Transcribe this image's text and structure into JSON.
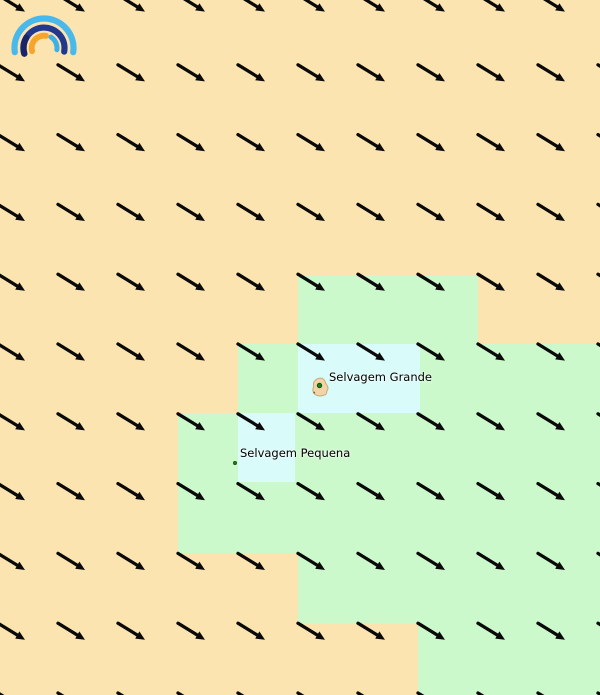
{
  "app": {
    "name": "meteoblue weather map",
    "view": "wind direction overlay"
  },
  "logo": {
    "icon": "meteoblue-rainbow-logo",
    "colors": {
      "outer_blue": "#49b8ea",
      "navy": "#22388e",
      "navy_dark": "#1a2569",
      "inner_blue": "#3fb0e5",
      "orange": "#f7a42c"
    }
  },
  "map": {
    "background_color": "#fce4b0",
    "tile_colors": {
      "peach": "#fce4b0",
      "green": "#ccf9cb",
      "cyan": "#d9fbfa"
    },
    "regions": [
      {
        "kind": "green",
        "x": 298,
        "y": 275,
        "w": 180,
        "h": 69
      },
      {
        "kind": "green",
        "x": 238,
        "y": 344,
        "w": 362,
        "h": 69
      },
      {
        "kind": "green",
        "x": 178,
        "y": 413,
        "w": 422,
        "h": 140
      },
      {
        "kind": "green",
        "x": 298,
        "y": 553,
        "w": 302,
        "h": 70
      },
      {
        "kind": "green",
        "x": 418,
        "y": 622,
        "w": 182,
        "h": 73
      },
      {
        "kind": "cyan",
        "x": 298,
        "y": 344,
        "w": 122,
        "h": 69
      },
      {
        "kind": "cyan",
        "x": 238,
        "y": 413,
        "w": 57,
        "h": 69
      }
    ],
    "islands": {
      "grande": {
        "label": "Selvagem Grande",
        "label_x": 329,
        "label_y": 371,
        "dot_x": 319.5,
        "dot_y": 385.5,
        "fill": "#f2d4a6",
        "stroke": "#c3a87b",
        "dot_color": "#1d7a1d",
        "dot_ring": "#0c4d0c"
      },
      "pequena": {
        "label": "Selvagem Pequena",
        "label_x": 240,
        "label_y": 447,
        "dot_x": 235,
        "dot_y": 463,
        "dot_color": "#1d7a1d",
        "dot_ring": "#0c4d0c"
      }
    },
    "wind": {
      "direction": "from northwest, arrows point southeast",
      "arrow_color": "#0a0a0a",
      "grid": {
        "x_start": -2,
        "x_step": 60,
        "cols": 11,
        "y_start": -5,
        "y_step": 69.8,
        "rows": 11,
        "dx": 26,
        "dy": 16
      }
    }
  }
}
